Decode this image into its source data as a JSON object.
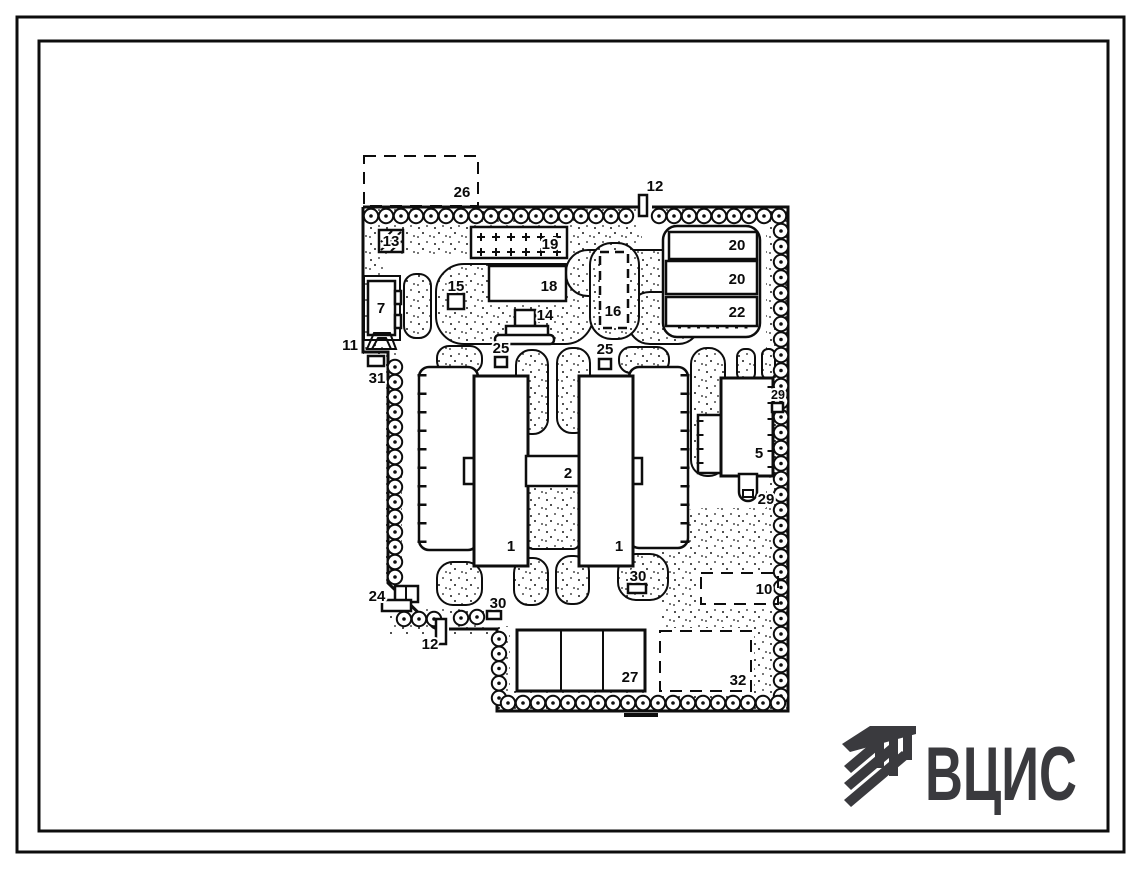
{
  "colors": {
    "ink": "#111111",
    "paper": "#ffffff",
    "logo": "#3a3a3e"
  },
  "logo": {
    "text": "ВЦИС"
  },
  "plan": {
    "labels": {
      "area26": "26",
      "gate12_top": "12",
      "b13": "13",
      "b19": "19",
      "b18": "18",
      "b15": "15",
      "b14": "14",
      "b16": "16",
      "b20a": "20",
      "b20b": "20",
      "b22": "22",
      "b7": "7",
      "b11": "11",
      "b31": "31",
      "b25a": "25",
      "b25b": "25",
      "b29a": "29",
      "b2": "2",
      "b1a": "1",
      "b1b": "1",
      "b5": "5",
      "b29b": "29",
      "b24": "24",
      "b30a": "30",
      "b30b": "30",
      "gate12_bottom": "12",
      "a10": "10",
      "b27": "27",
      "a32": "32"
    }
  }
}
